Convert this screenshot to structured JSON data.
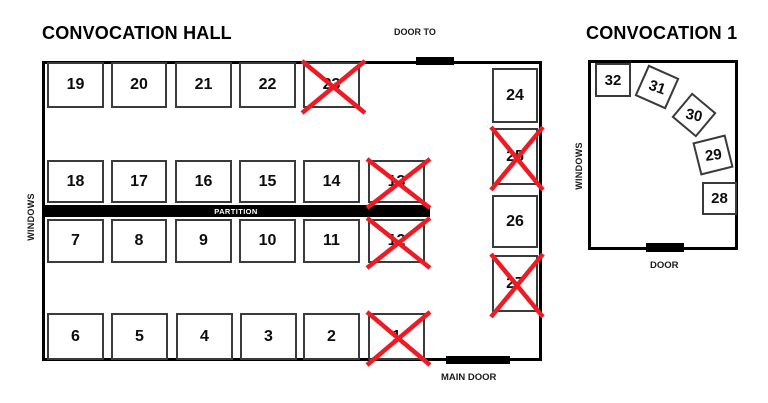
{
  "hall": {
    "title": "CONVOCATION HALL",
    "windows_label": "WINDOWS",
    "partition_label": "PARTITION",
    "door_to_label": "DOOR TO",
    "main_door_label": "MAIN DOOR",
    "booths": [
      {
        "n": "19",
        "x": 47,
        "y": 62,
        "w": 57,
        "h": 46,
        "crossed": false
      },
      {
        "n": "20",
        "x": 111,
        "y": 62,
        "w": 56,
        "h": 46,
        "crossed": false
      },
      {
        "n": "21",
        "x": 175,
        "y": 62,
        "w": 57,
        "h": 46,
        "crossed": false
      },
      {
        "n": "22",
        "x": 239,
        "y": 62,
        "w": 57,
        "h": 46,
        "crossed": false
      },
      {
        "n": "23",
        "x": 303,
        "y": 62,
        "w": 57,
        "h": 46,
        "crossed": true
      },
      {
        "n": "24",
        "x": 492,
        "y": 68,
        "w": 46,
        "h": 55,
        "crossed": false
      },
      {
        "n": "25",
        "x": 492,
        "y": 128,
        "w": 46,
        "h": 57,
        "crossed": true
      },
      {
        "n": "26",
        "x": 492,
        "y": 195,
        "w": 46,
        "h": 53,
        "crossed": false
      },
      {
        "n": "27",
        "x": 492,
        "y": 255,
        "w": 46,
        "h": 57,
        "crossed": true
      },
      {
        "n": "18",
        "x": 47,
        "y": 160,
        "w": 57,
        "h": 43,
        "crossed": false
      },
      {
        "n": "17",
        "x": 111,
        "y": 160,
        "w": 56,
        "h": 43,
        "crossed": false
      },
      {
        "n": "16",
        "x": 175,
        "y": 160,
        "w": 57,
        "h": 43,
        "crossed": false
      },
      {
        "n": "15",
        "x": 239,
        "y": 160,
        "w": 57,
        "h": 43,
        "crossed": false
      },
      {
        "n": "14",
        "x": 303,
        "y": 160,
        "w": 57,
        "h": 43,
        "crossed": false
      },
      {
        "n": "13",
        "x": 368,
        "y": 160,
        "w": 57,
        "h": 43,
        "crossed": true
      },
      {
        "n": "7",
        "x": 47,
        "y": 219,
        "w": 57,
        "h": 44,
        "crossed": false
      },
      {
        "n": "8",
        "x": 111,
        "y": 219,
        "w": 56,
        "h": 44,
        "crossed": false
      },
      {
        "n": "9",
        "x": 175,
        "y": 219,
        "w": 57,
        "h": 44,
        "crossed": false
      },
      {
        "n": "10",
        "x": 239,
        "y": 219,
        "w": 57,
        "h": 44,
        "crossed": false
      },
      {
        "n": "11",
        "x": 303,
        "y": 219,
        "w": 57,
        "h": 44,
        "crossed": false
      },
      {
        "n": "12",
        "x": 368,
        "y": 219,
        "w": 57,
        "h": 44,
        "crossed": true
      },
      {
        "n": "6",
        "x": 47,
        "y": 313,
        "w": 57,
        "h": 47,
        "crossed": false
      },
      {
        "n": "5",
        "x": 111,
        "y": 313,
        "w": 57,
        "h": 47,
        "crossed": false
      },
      {
        "n": "4",
        "x": 176,
        "y": 313,
        "w": 57,
        "h": 47,
        "crossed": false
      },
      {
        "n": "3",
        "x": 240,
        "y": 313,
        "w": 57,
        "h": 47,
        "crossed": false
      },
      {
        "n": "2",
        "x": 303,
        "y": 313,
        "w": 57,
        "h": 47,
        "crossed": false
      },
      {
        "n": "1",
        "x": 368,
        "y": 313,
        "w": 57,
        "h": 47,
        "crossed": true
      }
    ]
  },
  "room1": {
    "title": "CONVOCATION 1",
    "windows_label": "WINDOWS",
    "door_label": "DOOR",
    "booths": [
      {
        "n": "32",
        "x": 595,
        "y": 63,
        "w": 36,
        "h": 34,
        "r": 0,
        "tr": 0,
        "crossed": false
      },
      {
        "n": "31",
        "x": 640,
        "y": 70,
        "w": 34,
        "h": 34,
        "r": 24,
        "tr": -5,
        "crossed": false
      },
      {
        "n": "30",
        "x": 678,
        "y": 99,
        "w": 32,
        "h": 32,
        "r": 40,
        "tr": -28,
        "crossed": false
      },
      {
        "n": "29",
        "x": 696,
        "y": 138,
        "w": 34,
        "h": 34,
        "r": -14,
        "tr": 6,
        "crossed": false
      },
      {
        "n": "28",
        "x": 702,
        "y": 182,
        "w": 35,
        "h": 33,
        "r": 0,
        "tr": 0,
        "crossed": false
      }
    ]
  },
  "colors": {
    "cross": "#ED1C24",
    "wall": "#000000",
    "booth_border": "#3A3A3A"
  }
}
